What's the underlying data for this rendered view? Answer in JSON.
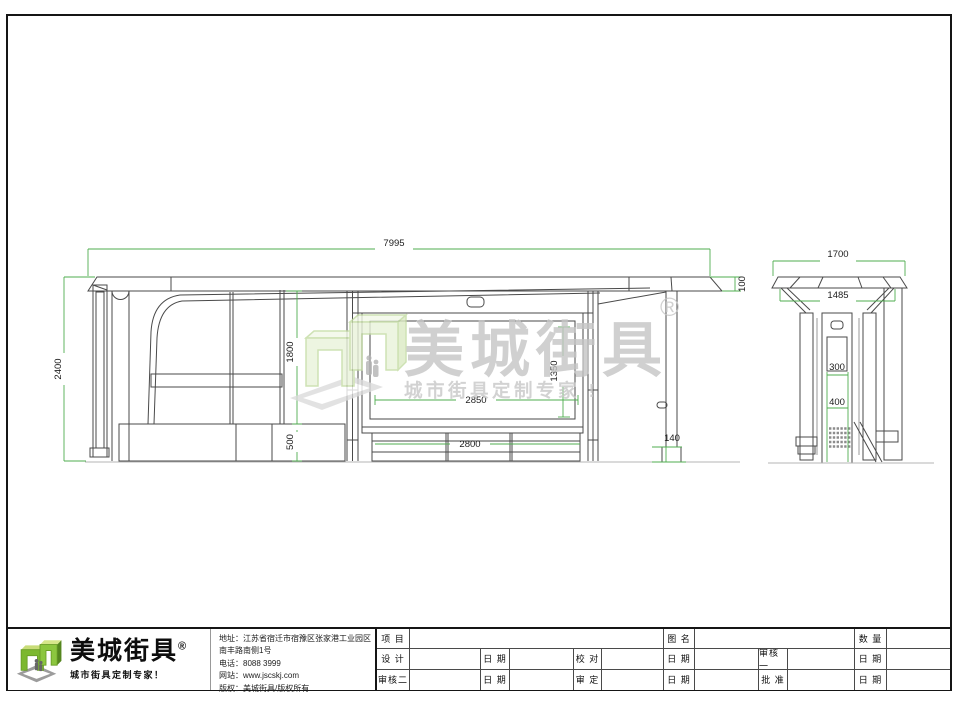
{
  "watermark": {
    "brand": "美城街具",
    "registered": "®",
    "tagline": "城市街具定制专家 !"
  },
  "dims": {
    "total_width": "7995",
    "total_height": "2400",
    "clear_height": "1800",
    "base_height": "500",
    "roof_thickness": "100",
    "ad_width": "2850",
    "ad_height": "1350",
    "bench_width": "2800",
    "post_base": "140",
    "side_roof_width": "1700",
    "side_canopy_width": "1485",
    "side_panel": "300",
    "side_grille": "400"
  },
  "title_block": {
    "logo": {
      "brand": "美城街具",
      "registered": "®",
      "tagline": "城市街具定制专家！"
    },
    "company": {
      "address": "地址：江苏省宿迁市宿豫区张家港工业园区南丰路南侧1号",
      "phone": "电话：8088 3999",
      "website": "网站：www.jscskj.com",
      "copyright": "版权：美城街具/版权所有"
    },
    "fields": {
      "project": "项 目",
      "drawing": "图 名",
      "qty": "数 量",
      "design": "设 计",
      "date": "日 期",
      "proof": "校 对",
      "review1": "审核一",
      "review2": "审核二",
      "finalize": "审 定",
      "approve": "批 准"
    }
  },
  "colors": {
    "dimension_green": "#4fae4f",
    "line_gray": "#4a4a4a",
    "logo_green": "#7cb82f",
    "watermark_gray": "#c5c5c5"
  }
}
